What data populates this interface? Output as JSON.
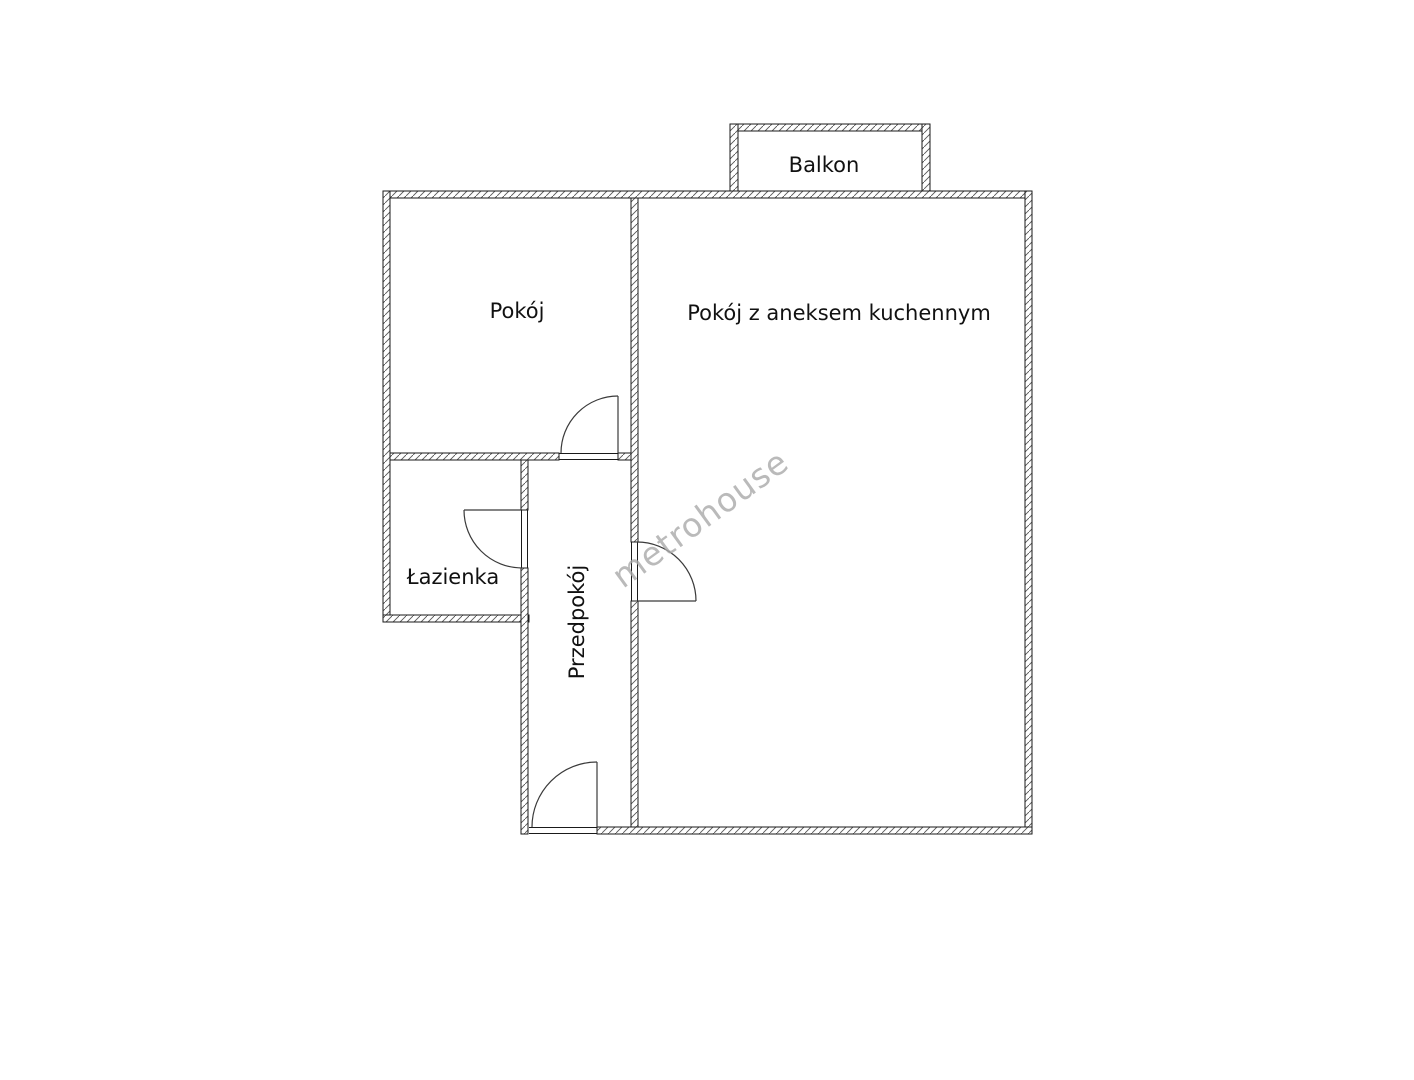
{
  "page": {
    "background": "#ffffff"
  },
  "floorplan": {
    "type": "apartment-floor-plan",
    "watermark": "metrohouse",
    "labels": {
      "balcony": "Balkon",
      "room": "Pokój",
      "living_kitchen": "Pokój z aneksem kuchennym",
      "bathroom": "Łazienka",
      "hallway": "Przedpokój"
    },
    "colors": {
      "wall_outline": "#1a1a1a",
      "hatch_line": "#555555",
      "door_line": "#3a3a3a",
      "label_text": "#111111",
      "watermark": "#a9a9a9",
      "background": "#ffffff"
    }
  }
}
